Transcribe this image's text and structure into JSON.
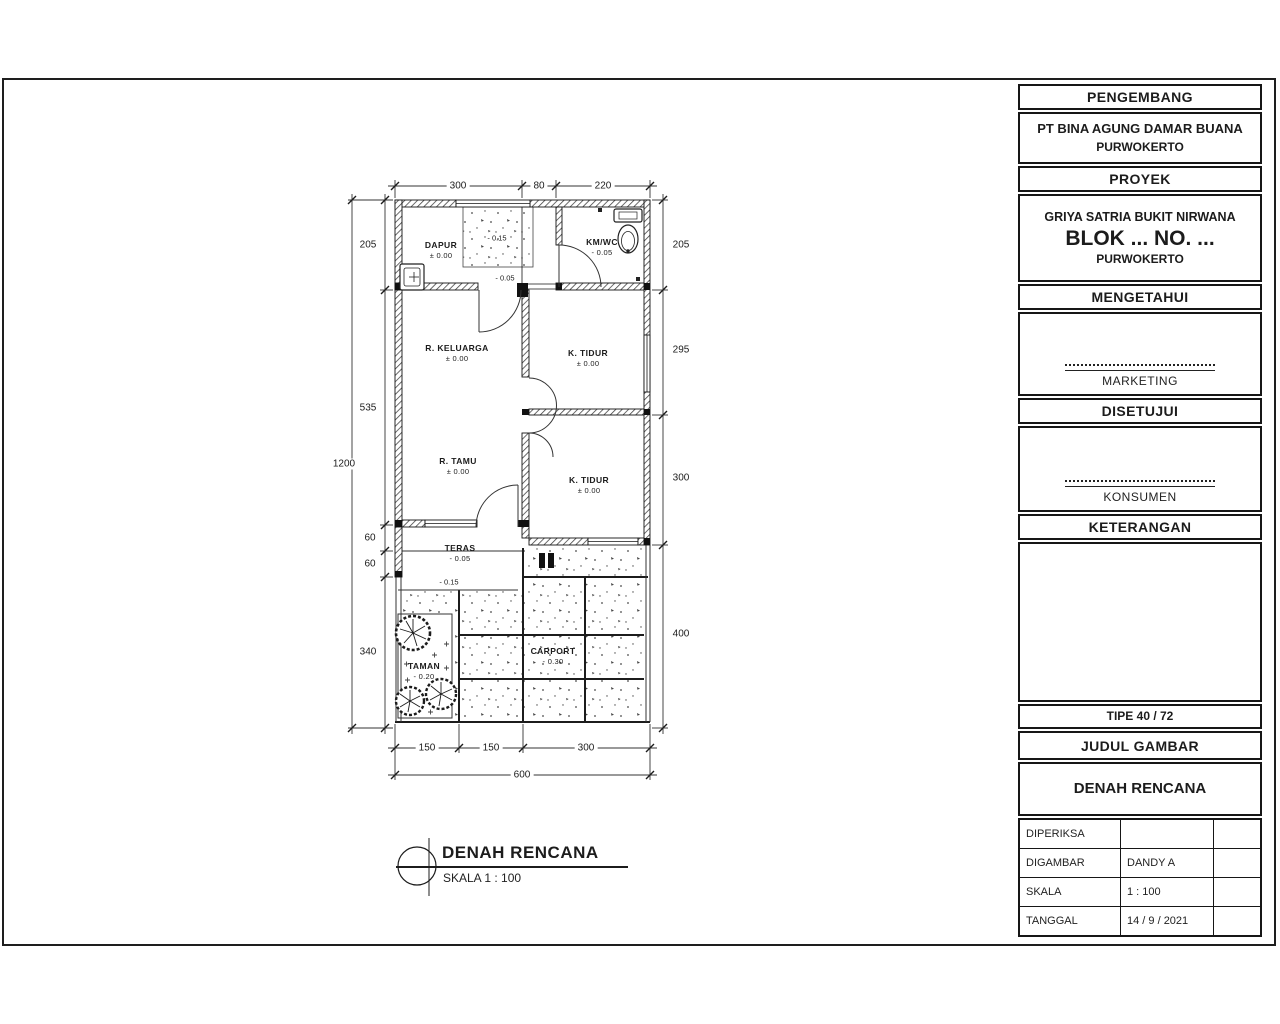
{
  "tb": {
    "s1": "PENGEMBANG",
    "s2a": "PT BINA AGUNG DAMAR BUANA",
    "s2b": "PURWOKERTO",
    "s3": "PROYEK",
    "s4a": "GRIYA SATRIA BUKIT NIRWANA",
    "s4b": "BLOK ... NO. ...",
    "s4c": "PURWOKERTO",
    "s5": "MENGETAHUI",
    "s6": "MARKETING",
    "s7": "DISETUJUI",
    "s8": "KONSUMEN",
    "s9": "KETERANGAN",
    "tipe": "TIPE 40 / 72",
    "judul": "JUDUL GAMBAR",
    "gambar": "DENAH RENCANA",
    "rows": [
      {
        "label": "DIPERIKSA",
        "value": ""
      },
      {
        "label": "DIGAMBAR",
        "value": "DANDY A"
      },
      {
        "label": "SKALA",
        "value": "1 : 100"
      },
      {
        "label": "TANGGAL",
        "value": "14 / 9 / 2021"
      }
    ]
  },
  "rooms": {
    "dapur": {
      "name": "DAPUR",
      "level": "± 0.00"
    },
    "kmwc": {
      "name": "KM/WC",
      "level": "- 0.05"
    },
    "keluarga": {
      "name": "R. KELUARGA",
      "level": "± 0.00"
    },
    "tidur1": {
      "name": "K. TIDUR",
      "level": "± 0.00"
    },
    "tamu": {
      "name": "R. TAMU",
      "level": "± 0.00"
    },
    "tidur2": {
      "name": "K. TIDUR",
      "level": "± 0.00"
    },
    "teras": {
      "name": "TERAS",
      "level": "- 0.05"
    },
    "taman": {
      "name": "TAMAN",
      "level": "- 0.20"
    },
    "carport": {
      "name": "CARPORT",
      "level": "- 0.30"
    }
  },
  "levels": {
    "wash": "- 0.15",
    "hall": "- 0.05",
    "step": "- 0.15"
  },
  "dims": {
    "top": [
      "300",
      "80",
      "220"
    ],
    "left": [
      "205",
      "535",
      "60",
      "60",
      "340"
    ],
    "left_total": "1200",
    "right": [
      "205",
      "295",
      "300",
      "400"
    ],
    "bottom": [
      "150",
      "150",
      "300"
    ],
    "bottom_total": "600"
  },
  "caption": {
    "title": "DENAH RENCANA",
    "scale": "SKALA 1 : 100"
  },
  "colors": {
    "line": "#1c1c1c",
    "hatch": "#3a3a3a",
    "stipple": "#4a4a4a"
  }
}
